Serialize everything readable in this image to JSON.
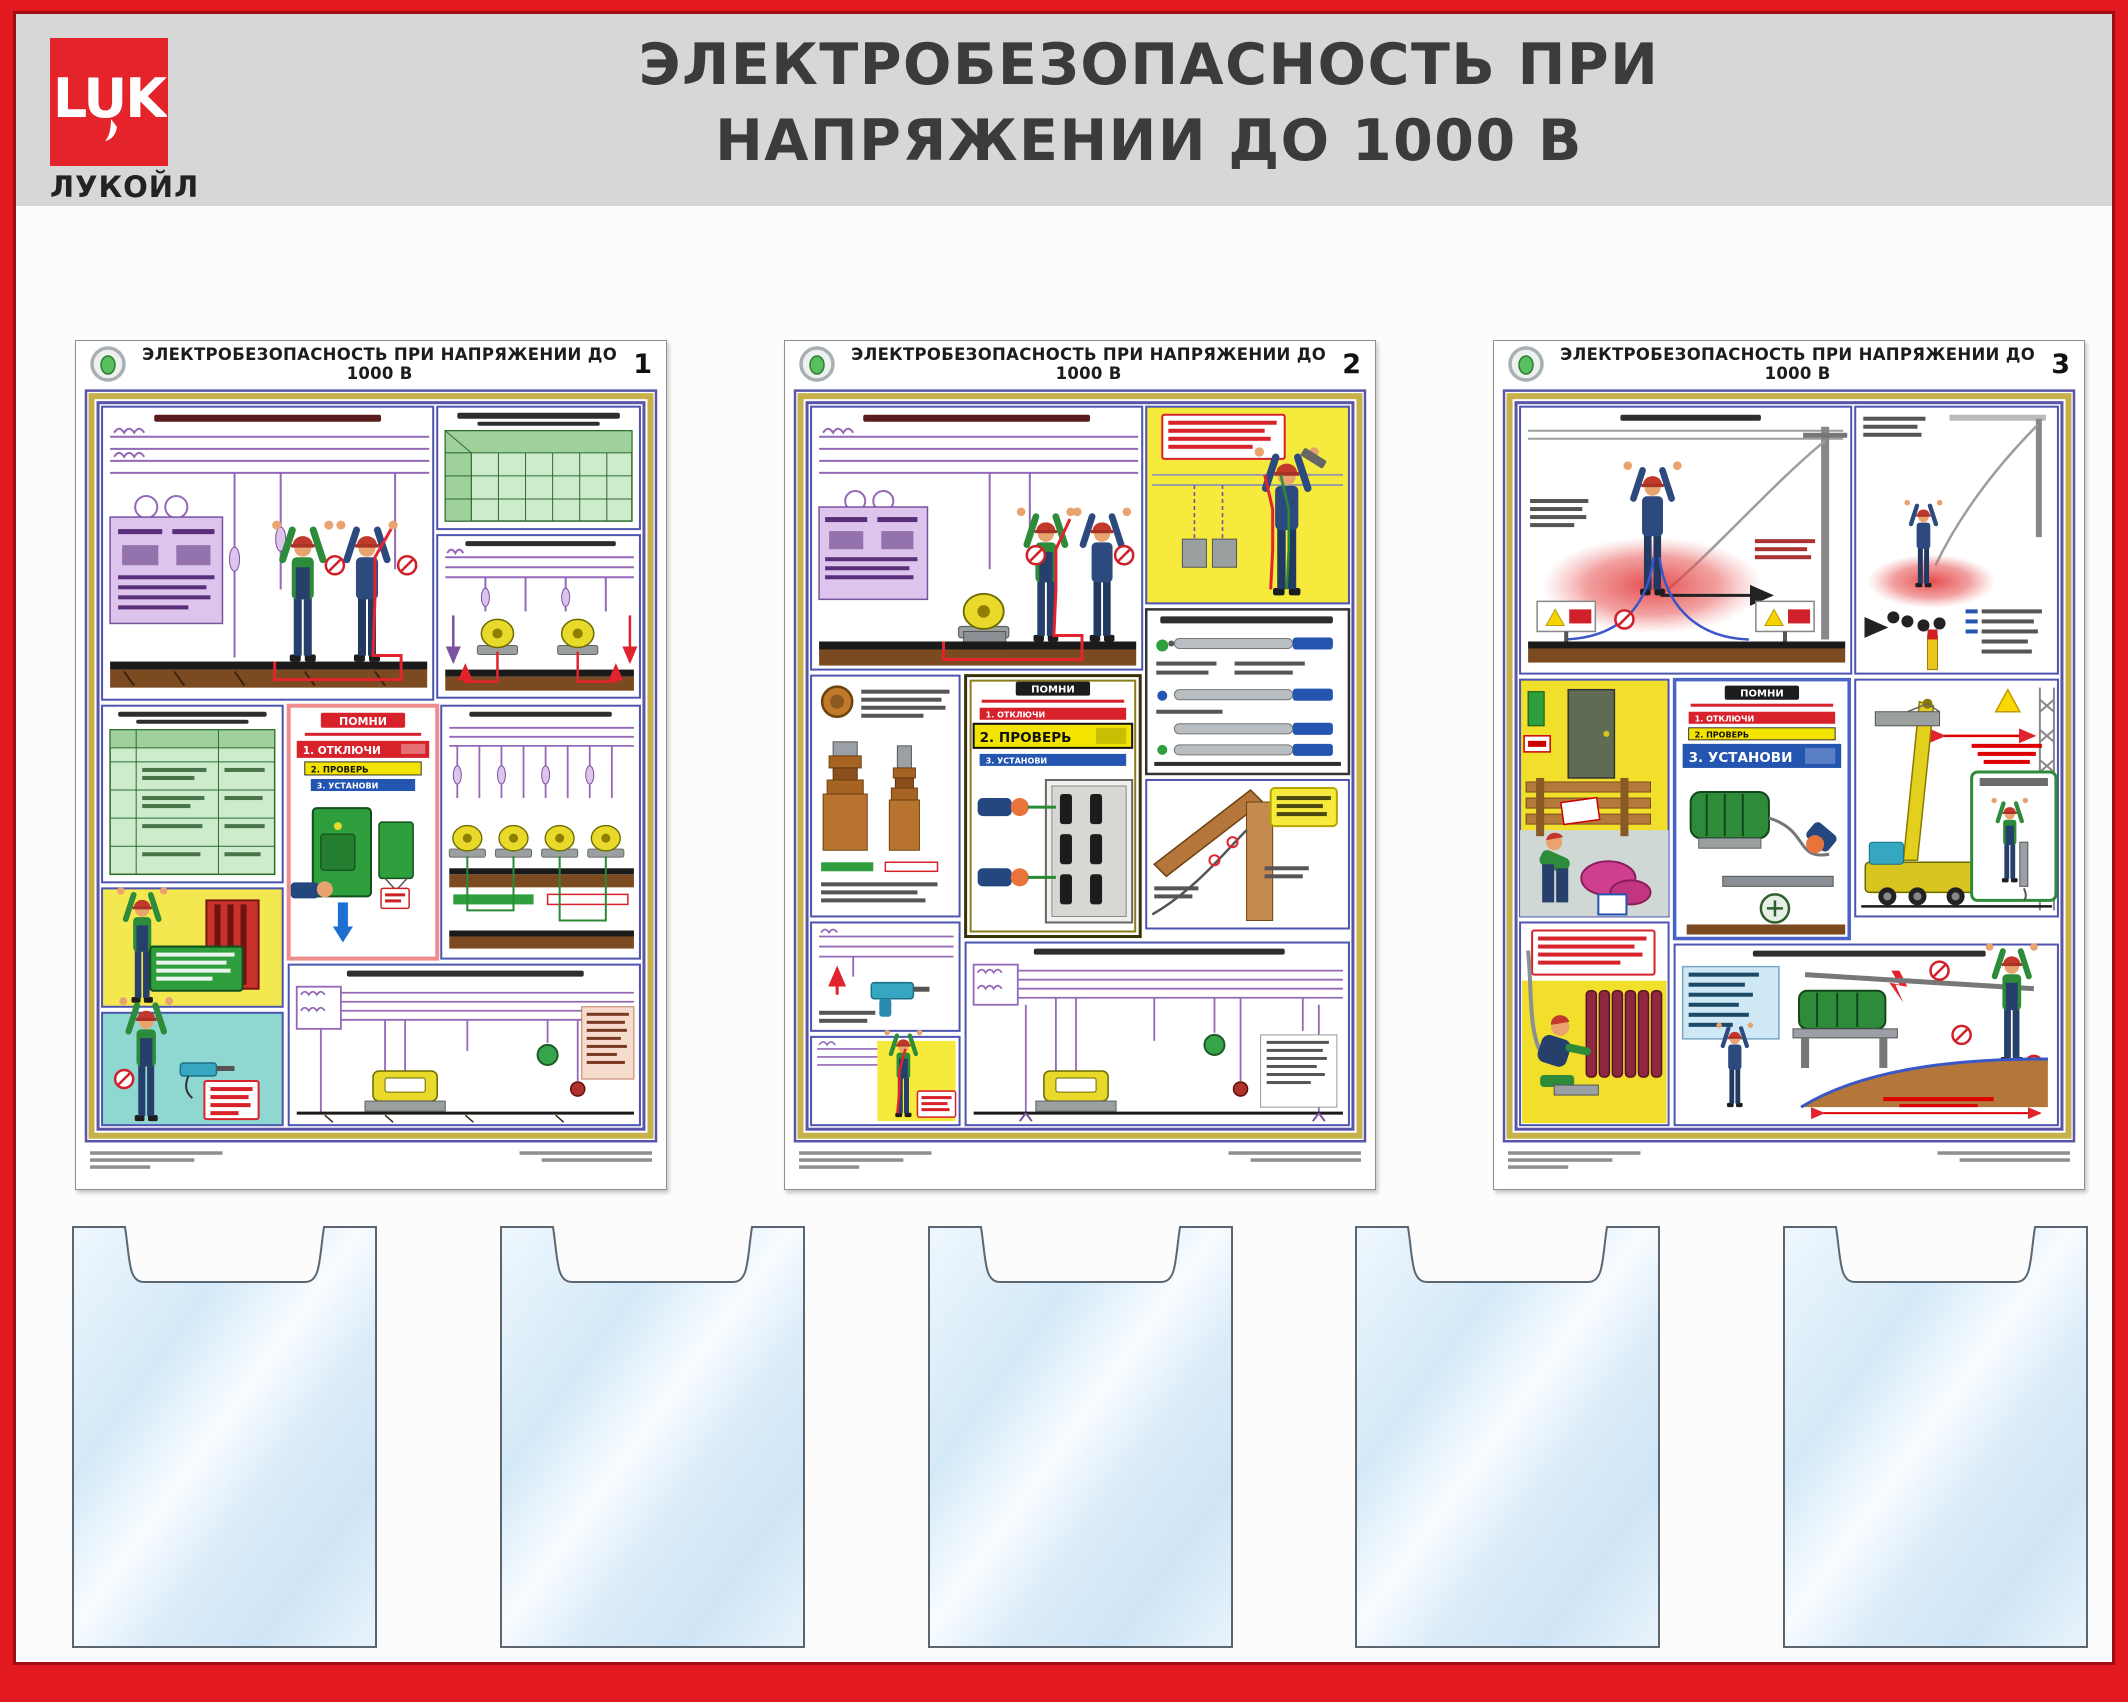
{
  "stand": {
    "title_line1": "ЭЛЕКТРОБЕЗОПАСНОСТЬ ПРИ",
    "title_line2": "НАПРЯЖЕНИИ ДО 1000 В",
    "frame_color": "#e21a20",
    "header_bg": "#d7d7d8"
  },
  "brand": {
    "logo_letters": "LUK",
    "name": "ЛУКОЙЛ",
    "logo_bg": "#e4232b"
  },
  "reminder": {
    "title": "ПОМНИ",
    "steps": [
      {
        "label": "1. ОТКЛЮЧИ",
        "color": "#d7222c"
      },
      {
        "label": "2. ПРОВЕРЬ",
        "color": "#f2e400"
      },
      {
        "label": "3. УСТАНОВИ",
        "color": "#2455b0"
      }
    ]
  },
  "posters": [
    {
      "number": "1",
      "title": "ЭЛЕКТРОБЕЗОПАСНОСТЬ ПРИ НАПРЯЖЕНИИ ДО 1000 В",
      "emphasized_step": "1. ОТКЛЮЧИ"
    },
    {
      "number": "2",
      "title": "ЭЛЕКТРОБЕЗОПАСНОСТЬ ПРИ НАПРЯЖЕНИИ ДО 1000 В",
      "emphasized_step": "2. ПРОВЕРЬ"
    },
    {
      "number": "3",
      "title": "ЭЛЕКТРОБЕЗОПАСНОСТЬ ПРИ НАПРЯЖЕНИИ ДО 1000 В",
      "emphasized_step": "3. УСТАНОВИ"
    }
  ],
  "pockets": {
    "count": 5
  }
}
